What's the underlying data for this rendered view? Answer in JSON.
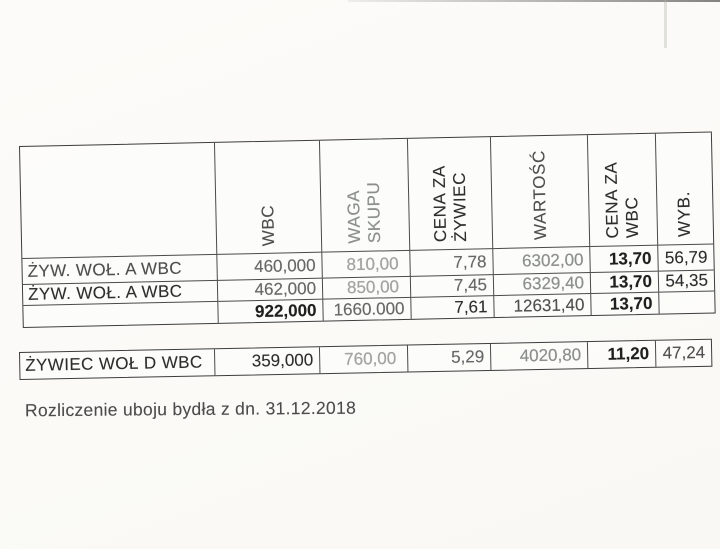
{
  "document": {
    "caption": "Rozliczenie uboju bydła z dn. 31.12.2018"
  },
  "colors": {
    "paper": "#fbfaf7",
    "table_line": "#3d3d3d",
    "ink": "#2d2d2d",
    "faded_ink": "#a3a3a1"
  },
  "main_table": {
    "headers": [
      "",
      "WBC",
      "WAGA\nSKUPU",
      "CENA ZA\nŻYWIEC",
      "WARTOŚĆ",
      "CENA ZA\nWBC",
      "WYB."
    ],
    "rows": [
      {
        "cells": [
          "ŻYW. WOŁ. A WBC",
          "460,000",
          "810,00",
          "7,78",
          "6302,00",
          "13,70",
          "56,79"
        ]
      },
      {
        "cells": [
          "ŻYW. WOŁ. A WBC",
          "462,000",
          "850,00",
          "7,45",
          "6329,40",
          "13,70",
          "54,35"
        ]
      },
      {
        "cells": [
          "",
          "922,000",
          "1660.000",
          "7,61",
          "12631,40",
          "13,70",
          ""
        ]
      }
    ]
  },
  "summary_row": {
    "cells": [
      "ŻYWIEC WOŁ D WBC",
      "359,000",
      "760,00",
      "5,29",
      "4020,80",
      "11,20",
      "47,24"
    ]
  }
}
